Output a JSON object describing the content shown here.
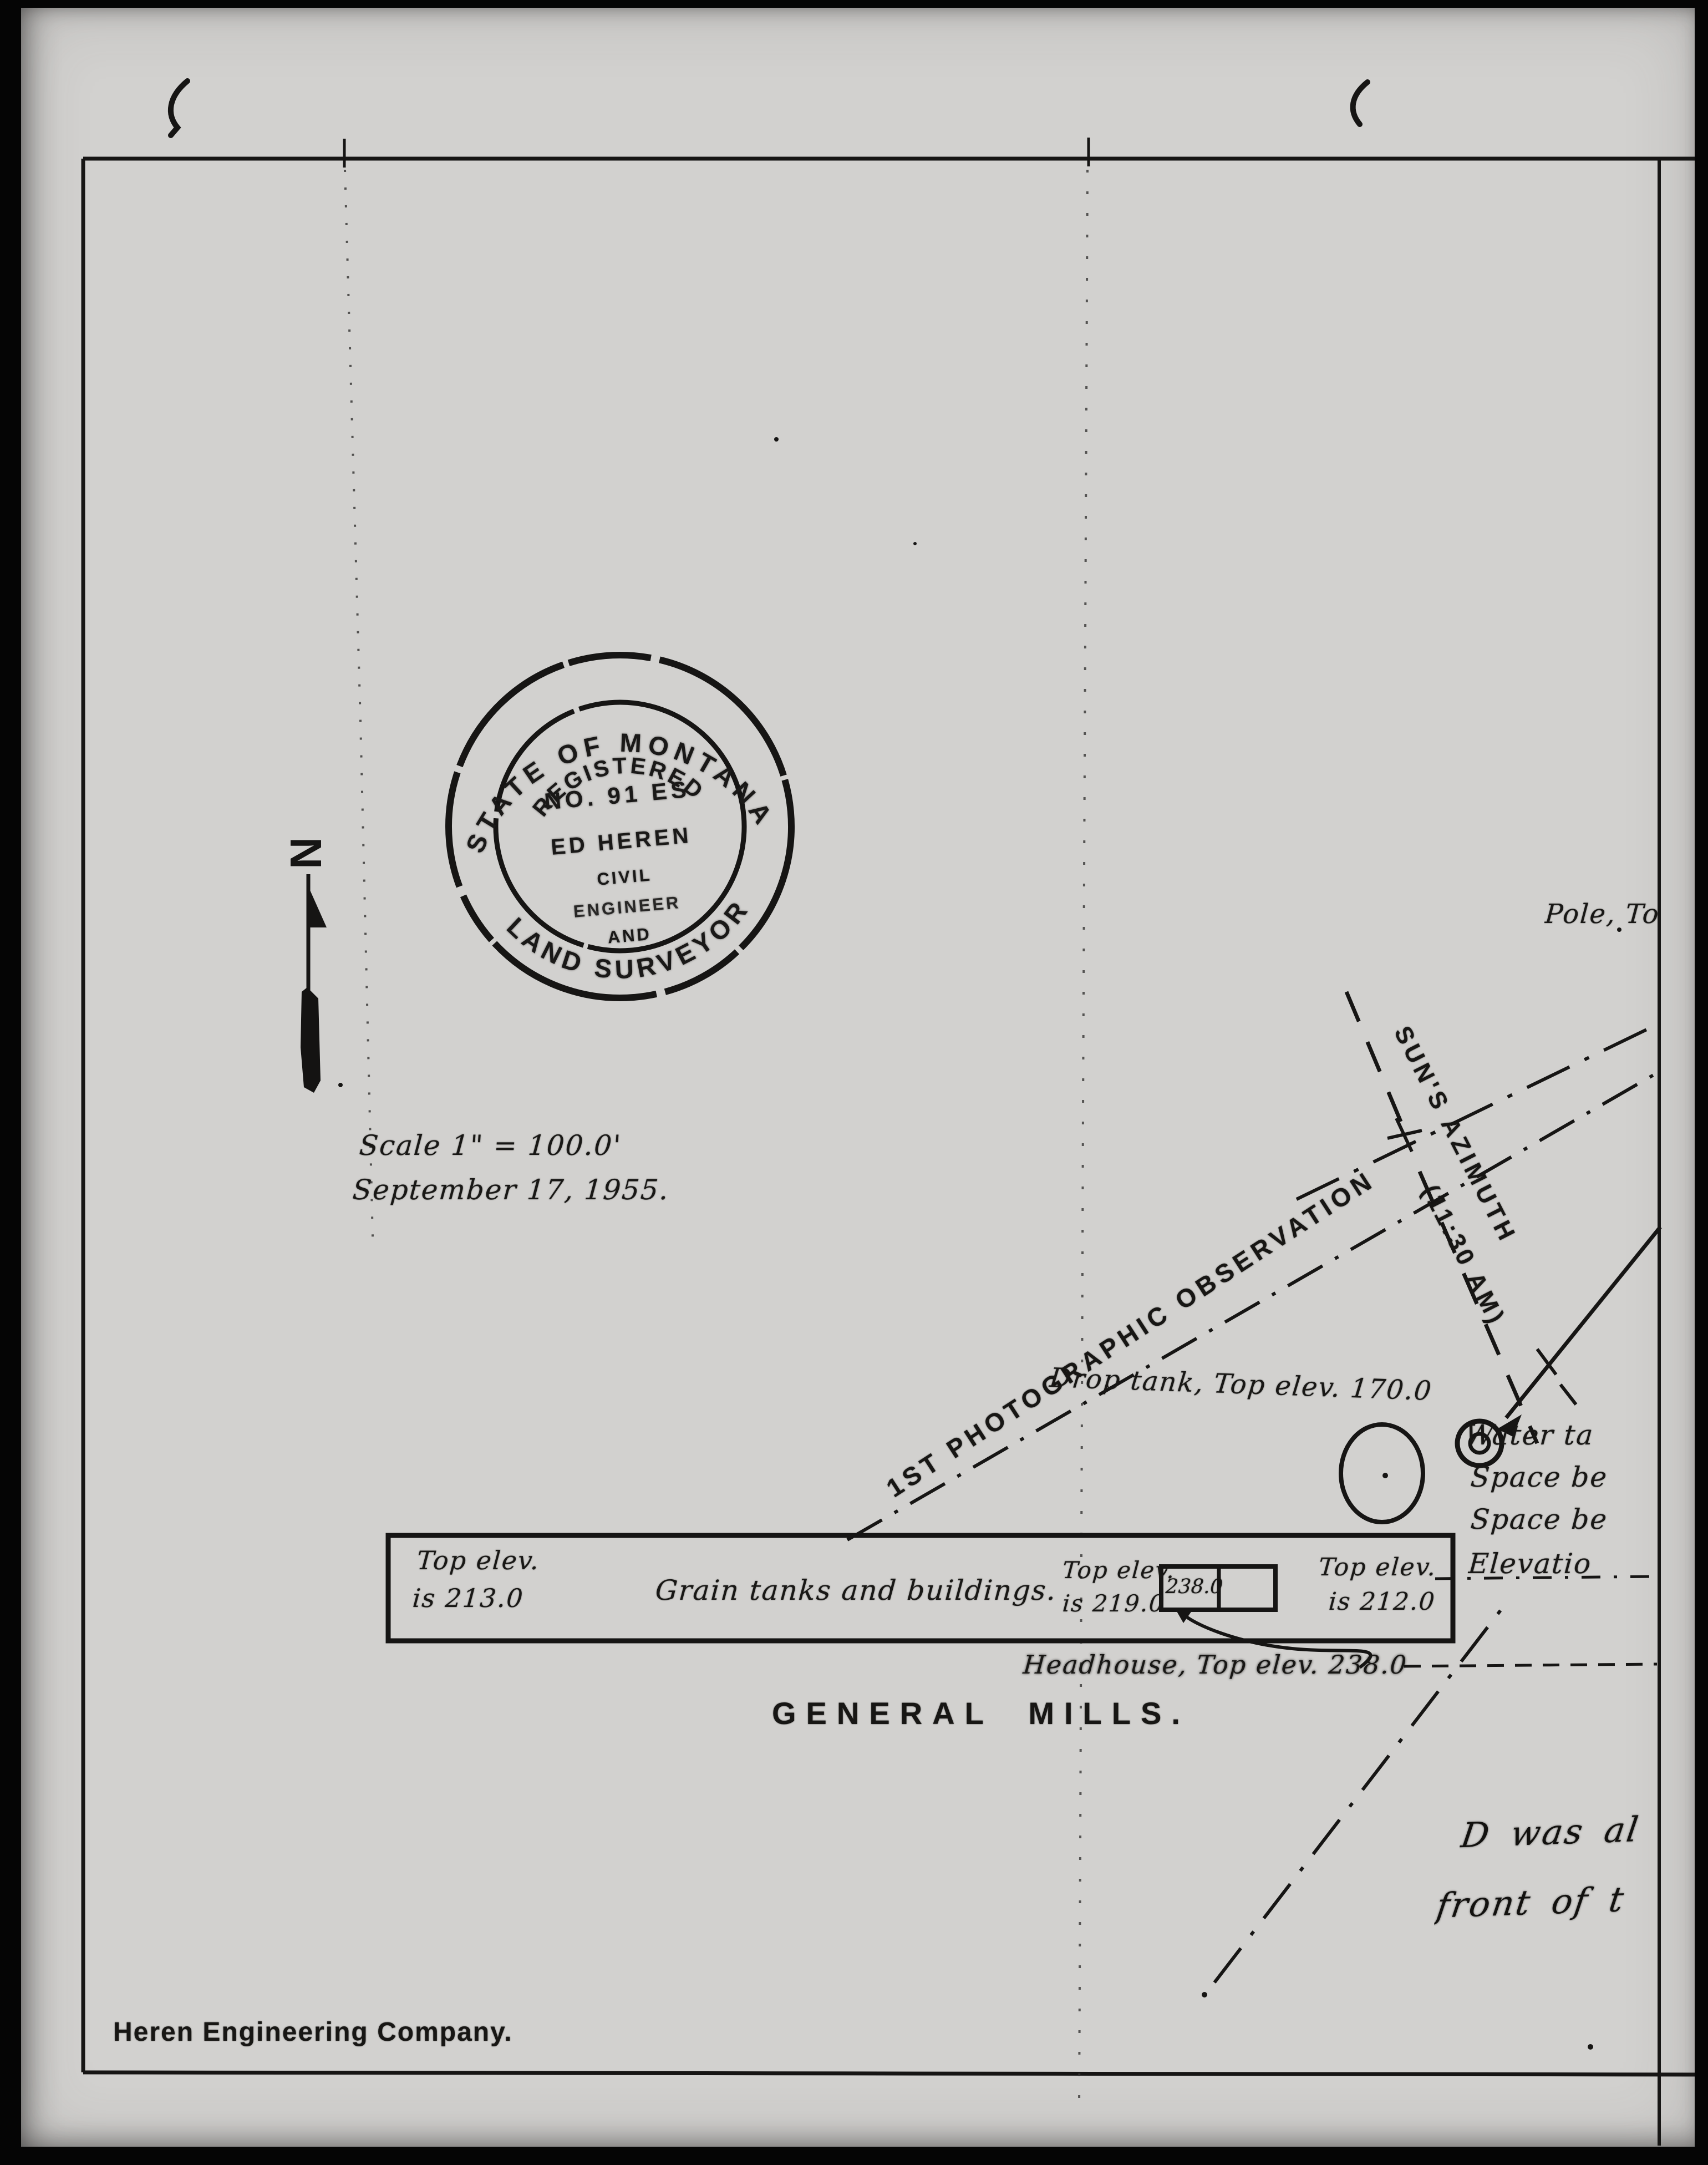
{
  "colors": {
    "paper": "#d2d1cf",
    "ink": "#161514"
  },
  "stamp": {
    "outer_top": "STATE OF MONTANA",
    "outer_bottom": "LAND SURVEYOR",
    "inner_arc": "REGISTERED",
    "number_line": "NO. 91 ES",
    "name_line": "ED HEREN",
    "title_line_1": "CIVIL",
    "title_line_2": "ENGINEER",
    "title_line_3": "AND"
  },
  "north": {
    "label": "N"
  },
  "notes": {
    "scale_note": "Scale 1\" = 100.0'",
    "date_note": "September 17, 1955.",
    "observation_label": "1ST PHOTOGRAPHIC OBSERVATION",
    "sun_azimuth_label": "SUN'S AZIMUTH",
    "sun_azimuth_time": "(11:30 AM)",
    "pole_label": "Pole, Top",
    "drop_tank_label": "Drop tank, Top elev. 170.0",
    "headhouse_note": "Headhouse, Top elev. 238.0",
    "margin_note_line1": "D was al",
    "margin_note_line2": "front of t"
  },
  "water_notes": [
    "Water ta",
    "Space be",
    "Space be",
    "Elevatio"
  ],
  "grain_box": {
    "left_elev_1": "Top elev.",
    "left_elev_2": "is 213.0",
    "center_label": "Grain tanks and buildings.",
    "mid_elev_1": "Top elev.",
    "mid_elev_2": "is 219.0",
    "headhouse_box_value": "238.0",
    "right_elev_1": "Top elev.",
    "right_elev_2": "is 212.0"
  },
  "titles": {
    "site_title": "GENERAL MILLS.",
    "firm_name": "Heren Engineering Company."
  }
}
